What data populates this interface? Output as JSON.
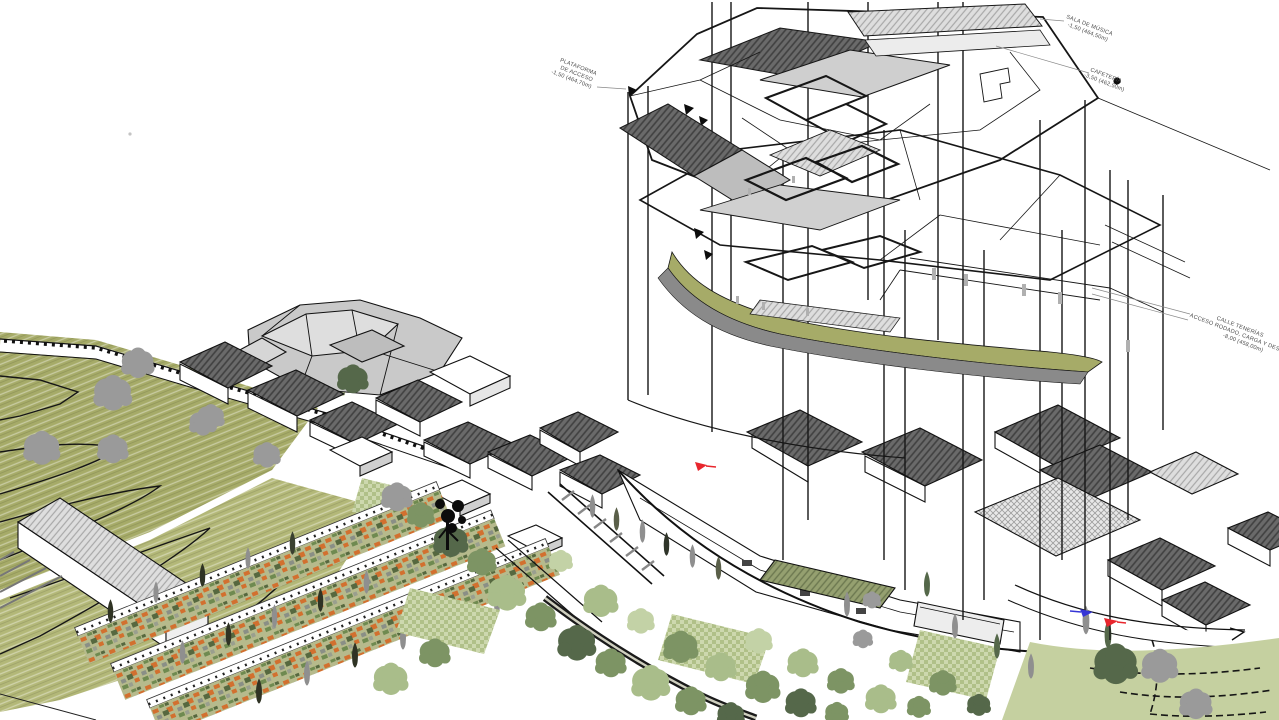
{
  "palette": {
    "background": "#ffffff",
    "ink": "#1a1a1a",
    "olive_hill": "#a6ab68",
    "olive_light": "#b3b878",
    "pale_green": "#c5d0a0",
    "leaf_dark": "#55684a",
    "leaf_mid": "#7d9464",
    "leaf_light": "#a9bd8a",
    "leaf_pale": "#c3d2a6",
    "tree_gray": "#9a9a9a",
    "roof_dark": "#6a6a6a",
    "roof_light": "#dedede",
    "crop_orange": "#d2702f",
    "marker_red": "#e8262d",
    "marker_blue": "#3535d6",
    "label_text": "#4a4a4a"
  },
  "annotations": {
    "plataforma": {
      "line1": "PLATAFORMA",
      "line2": "DE ACCESO",
      "line3": "-1,50 (464,70m)"
    },
    "sala_musica": {
      "line1": "SALA DE MÚSICA",
      "line2": "-1,50 (464,50m)"
    },
    "cafeteria": {
      "line1": "CAFETERÍA",
      "line2": "-3,50 (462,50m)"
    },
    "calle_tenerias": {
      "line1": "CALLE TENERÍAS",
      "line2": "ACCESO RODADO, CARGA Y DESCARGA",
      "line3": "-8,00 (458,00m)"
    }
  },
  "markers": {
    "red_arrow_upper": {
      "color": "#e8262d"
    },
    "blue_arrow": {
      "color": "#3535d6"
    },
    "red_arrow_lower": {
      "color": "#e8262d"
    }
  }
}
